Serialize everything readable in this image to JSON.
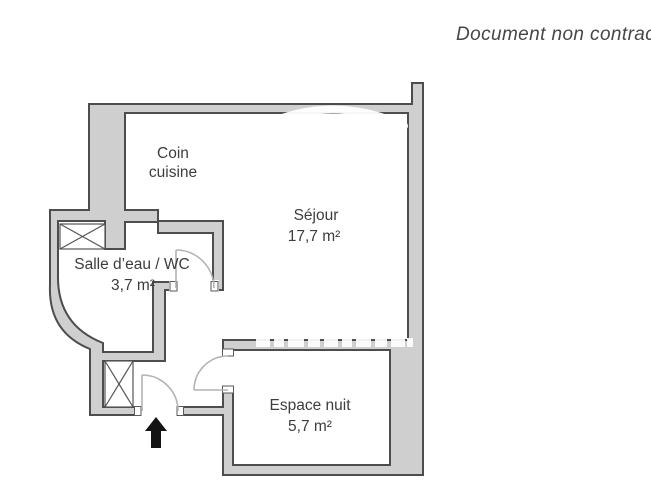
{
  "document": {
    "disclaimer": "Document non contractuel"
  },
  "floor_plan": {
    "rooms": [
      {
        "id": "coin-cuisine",
        "line1": "Coin",
        "line2": "cuisine"
      },
      {
        "id": "sejour",
        "name": "Séjour",
        "area": "17,7 m²"
      },
      {
        "id": "salle-eau-wc",
        "name": "Salle d’eau / WC",
        "area": "3,7 m²"
      },
      {
        "id": "espace-nuit",
        "name": "Espace nuit",
        "area": "5,7 m²"
      }
    ],
    "symbols": {
      "entrance_arrow": "up-arrow",
      "closet_boxes": 2,
      "doors": 3
    }
  },
  "colors": {
    "background": "#ffffff",
    "wall_fill": "#cfcfcf",
    "wall_outline": "#4d4d4d",
    "door_arc": "#b3b3b3",
    "text": "#3d3d3d",
    "arrow": "#141414",
    "watermark": "#ffffff"
  }
}
